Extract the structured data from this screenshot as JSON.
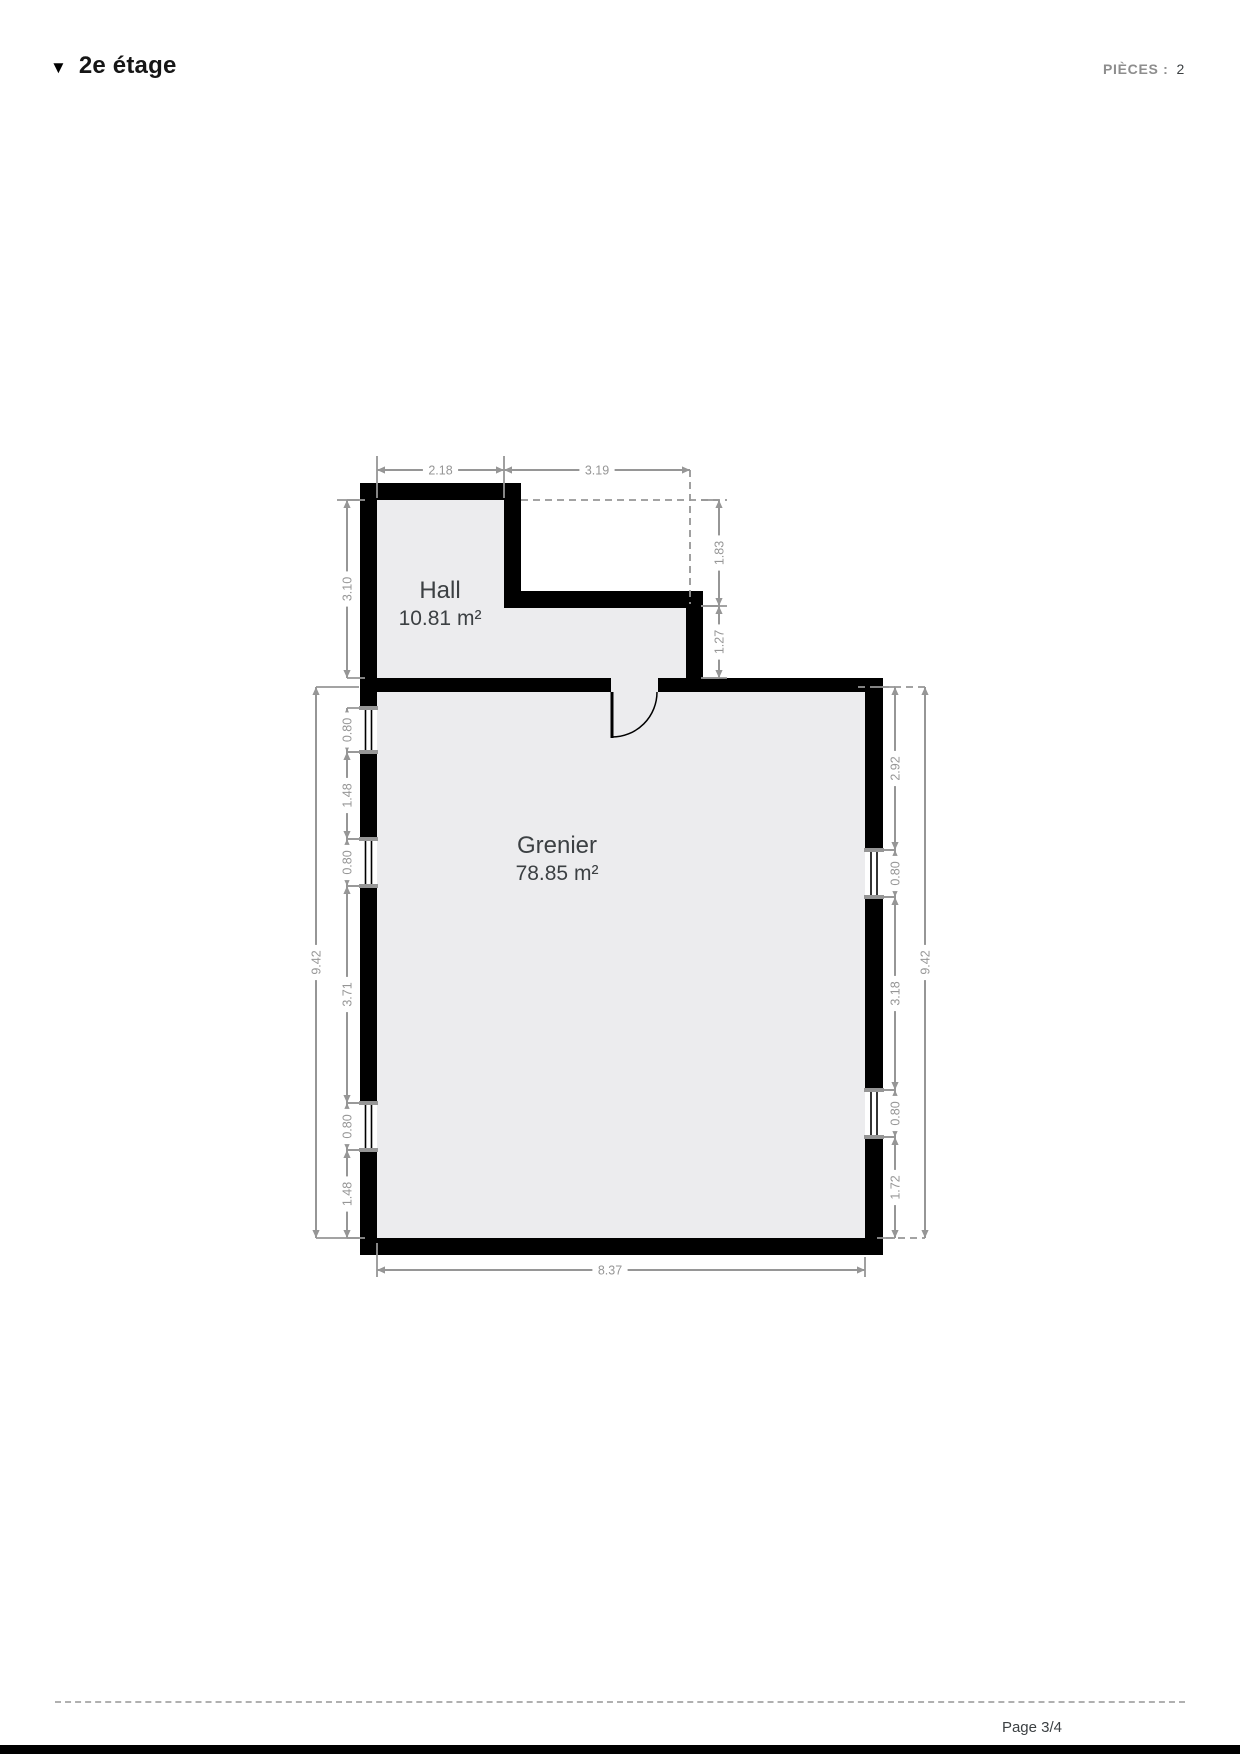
{
  "header": {
    "marker": "▼",
    "title": "2e étage",
    "pieces_label": "PIÈCES :",
    "pieces_value": "2"
  },
  "footer": {
    "page": "Page 3/4"
  },
  "plan": {
    "colors": {
      "wall": "#000000",
      "floor": "#ececee",
      "dim": "#969696",
      "label": "#3c4043"
    },
    "rooms": [
      {
        "name": "Hall",
        "area": "10.81 m²",
        "label_x": 440,
        "label_y": 598
      },
      {
        "name": "Grenier",
        "area": "78.85 m²",
        "label_x": 557,
        "label_y": 853
      }
    ],
    "floors": [
      {
        "name": "hall-floor",
        "points": "377,500 504,500 504,608 686,608 686,678 377,678"
      },
      {
        "name": "grenier-floor",
        "points": "377,692 865,692 865,1238 377,1238"
      },
      {
        "name": "door-opening-floor",
        "points": "611,678 658,678 658,692 611,692"
      }
    ],
    "walls": [
      [
        360,
        483,
        17,
        225
      ],
      [
        360,
        752,
        17,
        87
      ],
      [
        360,
        886,
        17,
        217
      ],
      [
        360,
        1150,
        17,
        105
      ],
      [
        360,
        483,
        161,
        17
      ],
      [
        504,
        500,
        17,
        91
      ],
      [
        504,
        591,
        199,
        17
      ],
      [
        686,
        608,
        17,
        70
      ],
      [
        377,
        678,
        234,
        14
      ],
      [
        658,
        678,
        225,
        14
      ],
      [
        865,
        678,
        18,
        172
      ],
      [
        865,
        897,
        18,
        193
      ],
      [
        865,
        1137,
        18,
        118
      ],
      [
        360,
        1238,
        523,
        17
      ]
    ],
    "windows": [
      {
        "x": 360,
        "w": 17,
        "y1": 708,
        "y2": 752
      },
      {
        "x": 360,
        "w": 17,
        "y1": 839,
        "y2": 886
      },
      {
        "x": 360,
        "w": 17,
        "y1": 1103,
        "y2": 1150
      },
      {
        "x": 865,
        "w": 18,
        "y1": 850,
        "y2": 897
      },
      {
        "x": 865,
        "w": 18,
        "y1": 1090,
        "y2": 1137
      }
    ],
    "door": {
      "hinge_x": 611,
      "hinge_y": 692,
      "jamb_x": 657,
      "radius": 45,
      "leaf_to_y": 738
    },
    "ext_lines": [
      {
        "x1": 377,
        "y1": 456,
        "x2": 377,
        "y2": 498
      },
      {
        "x1": 504,
        "y1": 456,
        "x2": 504,
        "y2": 498
      },
      {
        "x1": 690,
        "y1": 470,
        "x2": 690,
        "y2": 604,
        "dashed": true
      },
      {
        "x1": 521,
        "y1": 500,
        "x2": 727,
        "y2": 500,
        "dashed": true
      },
      {
        "x1": 703,
        "y1": 606,
        "x2": 727,
        "y2": 606
      },
      {
        "x1": 703,
        "y1": 678,
        "x2": 727,
        "y2": 678
      },
      {
        "x1": 337,
        "y1": 500,
        "x2": 359,
        "y2": 500
      },
      {
        "x1": 316,
        "y1": 687,
        "x2": 359,
        "y2": 687
      },
      {
        "x1": 316,
        "y1": 1238,
        "x2": 359,
        "y2": 1238
      },
      {
        "x1": 858,
        "y1": 687,
        "x2": 925,
        "y2": 687,
        "dashed": true
      },
      {
        "x1": 886,
        "y1": 1238,
        "x2": 925,
        "y2": 1238,
        "dashed": true
      },
      {
        "x1": 377,
        "y1": 1243,
        "x2": 377,
        "y2": 1277
      },
      {
        "x1": 865,
        "y1": 1257,
        "x2": 865,
        "y2": 1277
      }
    ],
    "dimensions": [
      {
        "label": "2.18",
        "axis": "h",
        "c": 470,
        "a": 377,
        "b": 504
      },
      {
        "label": "3.19",
        "axis": "h",
        "c": 470,
        "a": 504,
        "b": 690
      },
      {
        "label": "8.37",
        "axis": "h",
        "c": 1270,
        "a": 377,
        "b": 865,
        "lx": 610
      },
      {
        "label": "3.10",
        "axis": "v",
        "c": 347,
        "a": 500,
        "b": 678,
        "tick": 1
      },
      {
        "label": "1.83",
        "axis": "v",
        "c": 719,
        "a": 500,
        "b": 606,
        "tick": -1
      },
      {
        "label": "1.27",
        "axis": "v",
        "c": 719,
        "a": 606,
        "b": 678,
        "tick": -1
      },
      {
        "label": "9.42",
        "axis": "v",
        "c": 316,
        "a": 687,
        "b": 1238
      },
      {
        "label": "0.80",
        "axis": "v",
        "c": 347,
        "a": 708,
        "b": 752,
        "tick": 1
      },
      {
        "label": "1.48",
        "axis": "v",
        "c": 347,
        "a": 752,
        "b": 839,
        "tick": 1
      },
      {
        "label": "0.80",
        "axis": "v",
        "c": 347,
        "a": 839,
        "b": 886,
        "tick": 1
      },
      {
        "label": "3.71",
        "axis": "v",
        "c": 347,
        "a": 886,
        "b": 1103,
        "tick": 1
      },
      {
        "label": "0.80",
        "axis": "v",
        "c": 347,
        "a": 1103,
        "b": 1150,
        "tick": 1
      },
      {
        "label": "1.48",
        "axis": "v",
        "c": 347,
        "a": 1150,
        "b": 1238,
        "tick": 1
      },
      {
        "label": "2.92",
        "axis": "v",
        "c": 895,
        "a": 687,
        "b": 850,
        "tick": -1
      },
      {
        "label": "0.80",
        "axis": "v",
        "c": 895,
        "a": 850,
        "b": 897,
        "tick": -1
      },
      {
        "label": "3.18",
        "axis": "v",
        "c": 895,
        "a": 897,
        "b": 1090,
        "tick": -1
      },
      {
        "label": "0.80",
        "axis": "v",
        "c": 895,
        "a": 1090,
        "b": 1137,
        "tick": -1
      },
      {
        "label": "1.72",
        "axis": "v",
        "c": 895,
        "a": 1137,
        "b": 1238,
        "tick": -1
      },
      {
        "label": "9.42",
        "axis": "v",
        "c": 925,
        "a": 687,
        "b": 1238
      }
    ]
  }
}
